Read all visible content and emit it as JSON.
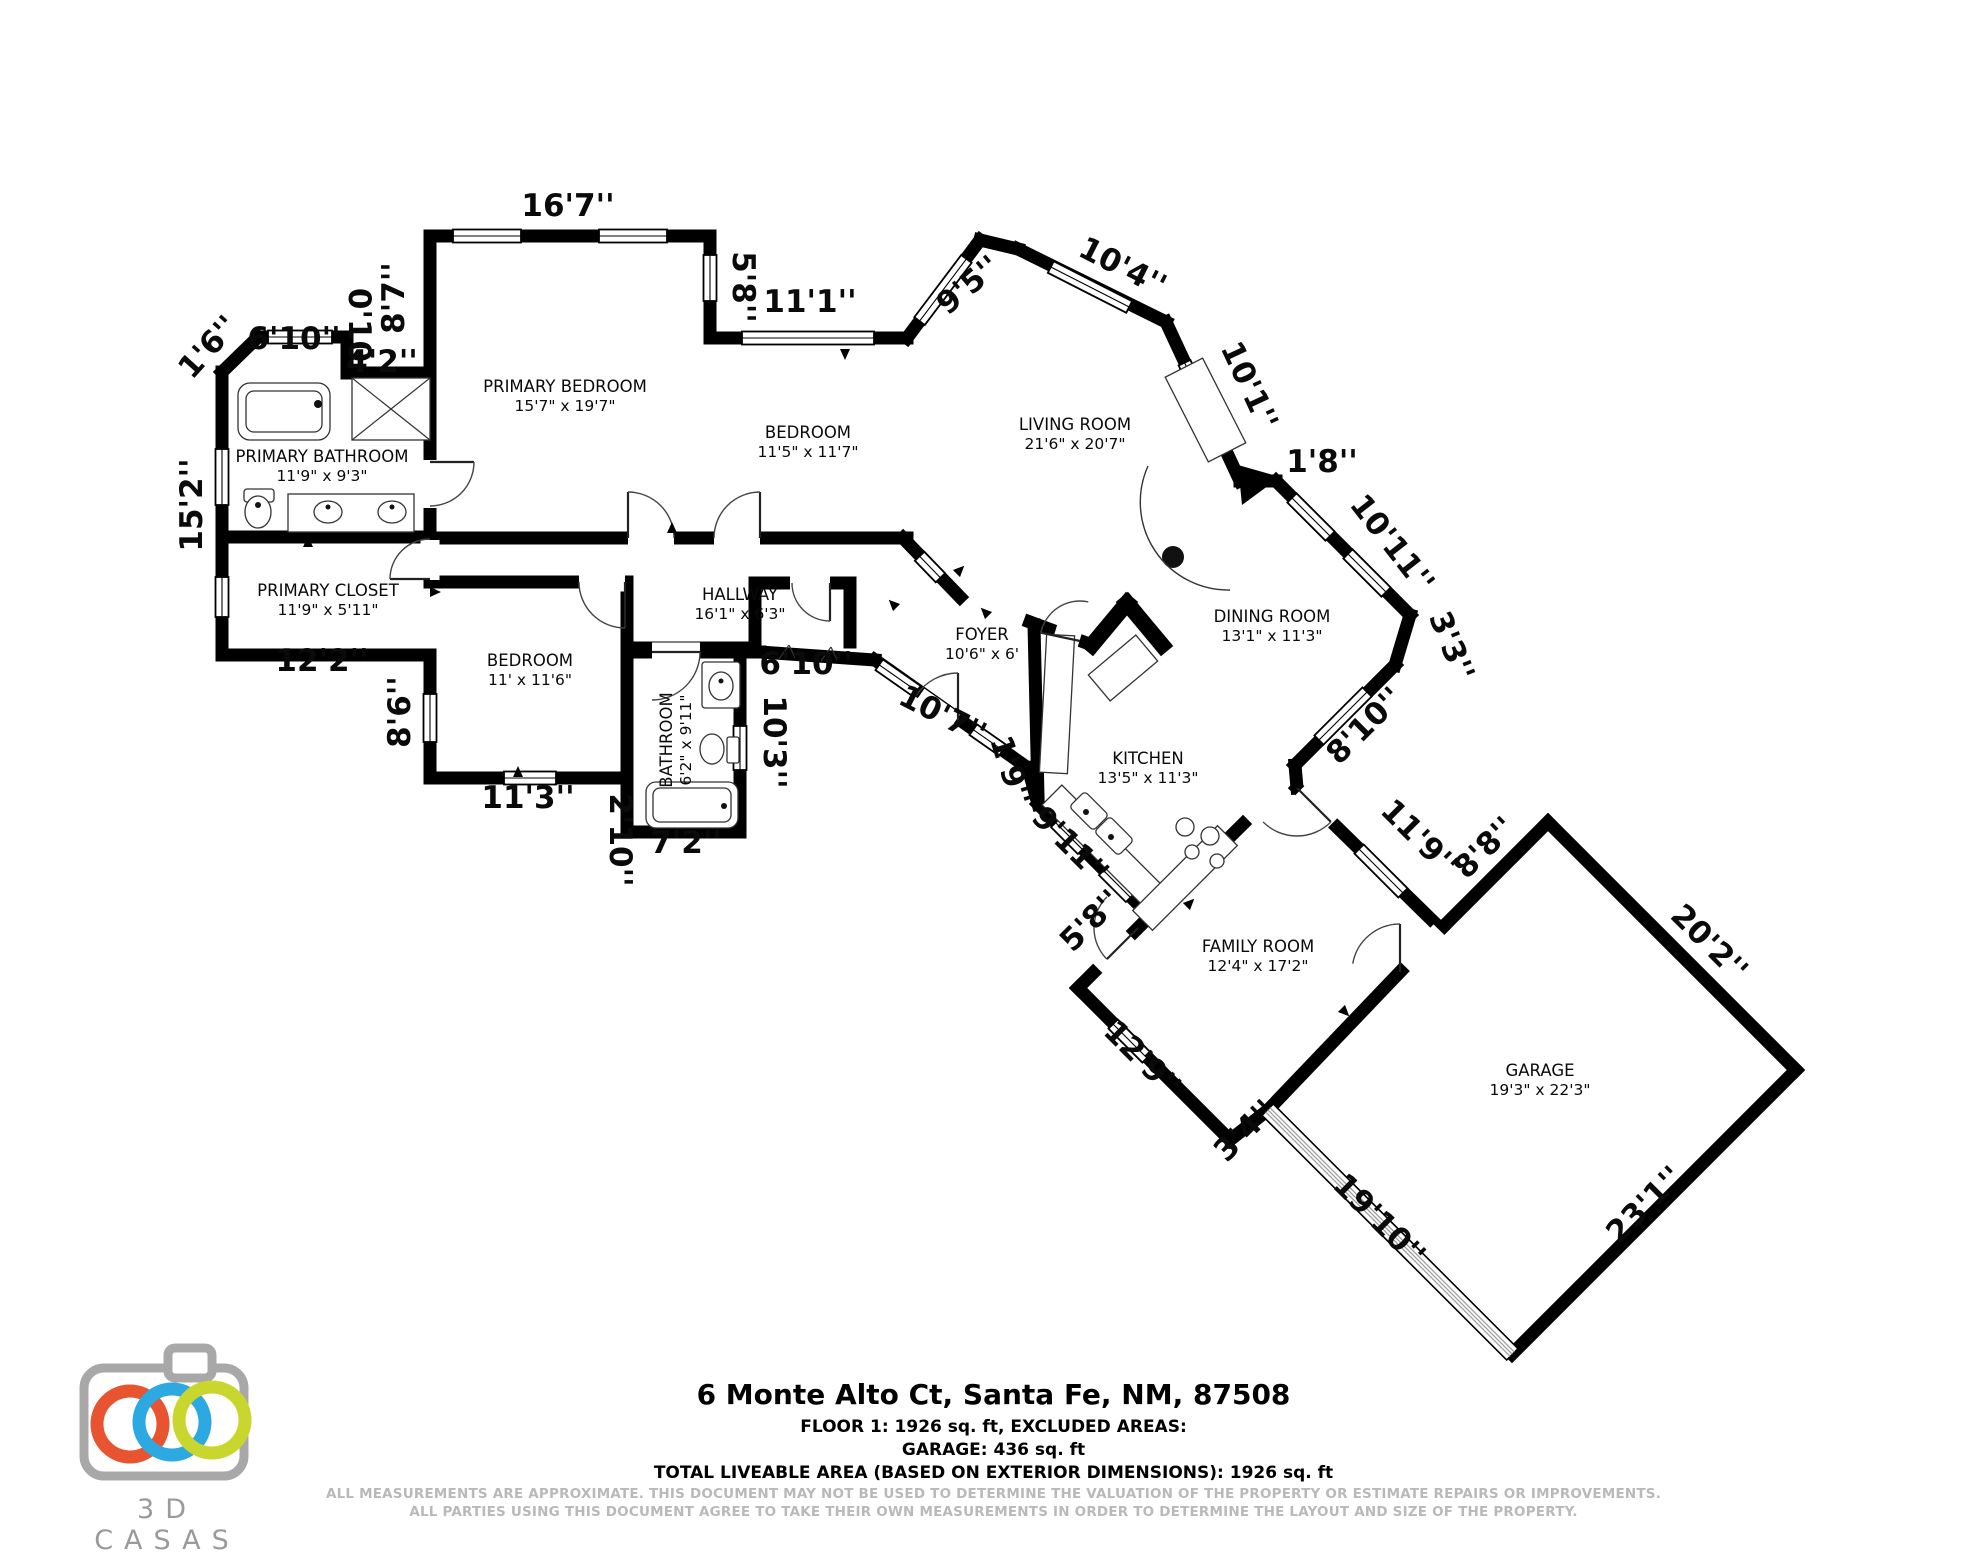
{
  "footer": {
    "title": "6 Monte Alto Ct, Santa Fe, NM, 87508",
    "line1": "FLOOR 1: 1926 sq. ft, EXCLUDED AREAS:",
    "line2": "GARAGE: 436 sq. ft",
    "line3": "TOTAL LIVEABLE AREA (BASED ON EXTERIOR DIMENSIONS): 1926 sq. ft",
    "disclaimer1": "ALL MEASUREMENTS ARE APPROXIMATE. THIS DOCUMENT MAY NOT BE USED TO DETERMINE THE VALUATION OF THE PROPERTY OR ESTIMATE REPAIRS OR IMPROVEMENTS.",
    "disclaimer2": "ALL PARTIES USING THIS DOCUMENT AGREE TO TAKE THEIR OWN MEASUREMENTS IN ORDER TO DETERMINE THE LAYOUT AND SIZE OF THE PROPERTY."
  },
  "logo": {
    "text": "3D CASAS",
    "colors": {
      "body": "#a8a8a8",
      "ring1": "#e8542f",
      "ring2": "#2ba9e0",
      "ring3": "#c9d62e"
    }
  },
  "floorplan": {
    "wall_color": "#000000",
    "rooms": [
      {
        "name": "PRIMARY BEDROOM",
        "dims": "15'7\" x 19'7\"",
        "x": 565,
        "y": 392,
        "rot": 0
      },
      {
        "name": "BEDROOM",
        "dims": "11'5\" x 11'7\"",
        "x": 808,
        "y": 438,
        "rot": 0
      },
      {
        "name": "LIVING ROOM",
        "dims": "21'6\" x 20'7\"",
        "x": 1075,
        "y": 430,
        "rot": 0
      },
      {
        "name": "PRIMARY BATHROOM",
        "dims": "11'9\" x 9'3\"",
        "x": 322,
        "y": 462,
        "rot": 0
      },
      {
        "name": "PRIMARY CLOSET",
        "dims": "11'9\" x 5'11\"",
        "x": 328,
        "y": 596,
        "rot": 0
      },
      {
        "name": "HALLWAY",
        "dims": "16'1\" x 6'3\"",
        "x": 740,
        "y": 600,
        "rot": 0
      },
      {
        "name": "BEDROOM",
        "dims": "11' x 11'6\"",
        "x": 530,
        "y": 666,
        "rot": 0
      },
      {
        "name": "BATHROOM",
        "dims": "6'2\" x 9'11\"",
        "x": 672,
        "y": 740,
        "rot": -90
      },
      {
        "name": "FOYER",
        "dims": "10'6\" x 6'",
        "x": 982,
        "y": 640,
        "rot": 0
      },
      {
        "name": "DINING ROOM",
        "dims": "13'1\" x 11'3\"",
        "x": 1272,
        "y": 622,
        "rot": 0
      },
      {
        "name": "KITCHEN",
        "dims": "13'5\" x 11'3\"",
        "x": 1148,
        "y": 764,
        "rot": 0
      },
      {
        "name": "FAMILY ROOM",
        "dims": "12'4\" x 17'2\"",
        "x": 1258,
        "y": 952,
        "rot": 0
      },
      {
        "name": "GARAGE",
        "dims": "19'3\" x 22'3\"",
        "x": 1540,
        "y": 1076,
        "rot": 0
      }
    ],
    "dim_labels": [
      {
        "t": "16'7''",
        "x": 568,
        "y": 216,
        "rot": 0
      },
      {
        "t": "8'7''",
        "x": 404,
        "y": 298,
        "rot": -90
      },
      {
        "t": "5'8''",
        "x": 733,
        "y": 287,
        "rot": 90
      },
      {
        "t": "11'1''",
        "x": 810,
        "y": 312,
        "rot": 0
      },
      {
        "t": "9'5''",
        "x": 975,
        "y": 293,
        "rot": -40
      },
      {
        "t": "10'4''",
        "x": 1118,
        "y": 276,
        "rot": 27
      },
      {
        "t": "10'1''",
        "x": 1240,
        "y": 390,
        "rot": 65
      },
      {
        "t": "1'8''",
        "x": 1322,
        "y": 472,
        "rot": 0
      },
      {
        "t": "10'11''",
        "x": 1384,
        "y": 550,
        "rot": 52
      },
      {
        "t": "3'3''",
        "x": 1442,
        "y": 650,
        "rot": 68
      },
      {
        "t": "8'10''",
        "x": 1372,
        "y": 733,
        "rot": -45
      },
      {
        "t": "11'9''",
        "x": 1412,
        "y": 845,
        "rot": 45
      },
      {
        "t": "8'8''",
        "x": 1492,
        "y": 855,
        "rot": -45
      },
      {
        "t": "20'2''",
        "x": 1702,
        "y": 950,
        "rot": 45
      },
      {
        "t": "23'1''",
        "x": 1652,
        "y": 1212,
        "rot": -45
      },
      {
        "t": "19'10''",
        "x": 1372,
        "y": 1227,
        "rot": 45
      },
      {
        "t": "3'4''",
        "x": 1252,
        "y": 1138,
        "rot": -45
      },
      {
        "t": "12'9''",
        "x": 1135,
        "y": 1066,
        "rot": 45
      },
      {
        "t": "5'8''",
        "x": 1098,
        "y": 928,
        "rot": -45
      },
      {
        "t": "9'11''",
        "x": 1063,
        "y": 852,
        "rot": 45
      },
      {
        "t": "1'9''",
        "x": 1001,
        "y": 774,
        "rot": 72
      },
      {
        "t": "10'7''",
        "x": 938,
        "y": 724,
        "rot": 27
      },
      {
        "t": "6'10''",
        "x": 806,
        "y": 674,
        "rot": 0
      },
      {
        "t": "10'3''",
        "x": 764,
        "y": 742,
        "rot": 90
      },
      {
        "t": "7'2''",
        "x": 686,
        "y": 853,
        "rot": 0
      },
      {
        "t": "2'10''",
        "x": 610,
        "y": 840,
        "rot": 90
      },
      {
        "t": "11'3''",
        "x": 528,
        "y": 808,
        "rot": 0
      },
      {
        "t": "8'6''",
        "x": 410,
        "y": 712,
        "rot": -90
      },
      {
        "t": "12'2''",
        "x": 322,
        "y": 671,
        "rot": 0
      },
      {
        "t": "15'2''",
        "x": 202,
        "y": 505,
        "rot": -90
      },
      {
        "t": "1'6''",
        "x": 216,
        "y": 354,
        "rot": -48
      },
      {
        "t": "6'10''",
        "x": 294,
        "y": 349,
        "rot": 0
      },
      {
        "t": "0'10",
        "x": 349,
        "y": 325,
        "rot": 90
      },
      {
        "t": "4'2''",
        "x": 382,
        "y": 372,
        "rot": 0
      }
    ],
    "walls": [
      [
        222,
        372,
        258,
        337
      ],
      [
        258,
        337,
        347,
        337
      ],
      [
        347,
        337,
        347,
        373
      ],
      [
        347,
        373,
        430,
        373
      ],
      [
        430,
        373,
        430,
        236
      ],
      [
        430,
        236,
        710,
        236
      ],
      [
        710,
        236,
        710,
        338
      ],
      [
        710,
        338,
        907,
        338
      ],
      [
        907,
        338,
        980,
        240
      ],
      [
        980,
        240,
        1018,
        249
      ],
      [
        1018,
        249,
        1166,
        322
      ],
      [
        1166,
        322,
        1240,
        481
      ],
      [
        1240,
        481,
        1276,
        481
      ],
      [
        1276,
        481,
        1410,
        615
      ],
      [
        1410,
        615,
        1395,
        665
      ],
      [
        1395,
        665,
        1295,
        765
      ],
      [
        1295,
        765,
        1297,
        788
      ],
      [
        1297,
        788,
        1441,
        929
      ],
      [
        1441,
        929,
        1548,
        822
      ],
      [
        1548,
        822,
        1796,
        1070
      ],
      [
        1796,
        1070,
        1512,
        1354
      ],
      [
        1268,
        1110,
        1230,
        1140
      ],
      [
        1230,
        1140,
        1078,
        988
      ],
      [
        1078,
        988,
        1150,
        916
      ],
      [
        1150,
        916,
        1038,
        804
      ],
      [
        1038,
        804,
        1028,
        768
      ],
      [
        1028,
        768,
        875,
        660
      ],
      [
        875,
        660,
        760,
        652
      ],
      [
        760,
        652,
        633,
        652
      ],
      [
        740,
        652,
        740,
        832
      ],
      [
        740,
        832,
        627,
        832
      ],
      [
        627,
        832,
        627,
        778
      ],
      [
        627,
        778,
        430,
        778
      ],
      [
        430,
        778,
        430,
        655
      ],
      [
        430,
        655,
        222,
        655
      ],
      [
        222,
        655,
        222,
        372
      ],
      [
        1441,
        929,
        1268,
        1110
      ],
      [
        222,
        537,
        430,
        537
      ],
      [
        430,
        373,
        430,
        582
      ],
      [
        430,
        538,
        907,
        538
      ],
      [
        430,
        582,
        627,
        582
      ],
      [
        627,
        582,
        627,
        778
      ],
      [
        633,
        648,
        755,
        648
      ],
      [
        755,
        648,
        755,
        583
      ],
      [
        755,
        583,
        850,
        583
      ],
      [
        850,
        583,
        850,
        642
      ],
      [
        903,
        538,
        960,
        597
      ],
      [
        1030,
        622,
        1092,
        645
      ],
      [
        1092,
        645,
        1127,
        603,
        16
      ],
      [
        1127,
        603,
        1162,
        645,
        16
      ],
      [
        1034,
        625,
        1038,
        796
      ],
      [
        1150,
        916,
        1243,
        824
      ]
    ],
    "gaps": [
      [
        430,
        484,
        48,
        90
      ],
      [
        430,
        560,
        40,
        90
      ],
      [
        651,
        538,
        46,
        0
      ],
      [
        737,
        538,
        46,
        0
      ],
      [
        602,
        582,
        46,
        0
      ],
      [
        676,
        652,
        48,
        0
      ],
      [
        937,
        709,
        44,
        35
      ],
      [
        1068,
        634,
        26,
        17
      ],
      [
        1114,
        952,
        46,
        -45
      ],
      [
        1316,
        807,
        46,
        45
      ],
      [
        1423,
        949,
        50,
        -46
      ],
      [
        810,
        583,
        40,
        0
      ]
    ],
    "windows": [
      [
        300,
        337,
        64,
        0
      ],
      [
        222,
        477,
        56,
        90
      ],
      [
        222,
        597,
        40,
        90
      ],
      [
        487,
        236,
        68,
        0
      ],
      [
        633,
        236,
        68,
        0
      ],
      [
        710,
        278,
        46,
        90
      ],
      [
        808,
        338,
        132,
        0
      ],
      [
        943,
        290,
        78,
        -53
      ],
      [
        1090,
        287,
        88,
        27
      ],
      [
        1201,
        398,
        78,
        65
      ],
      [
        1311,
        517,
        54,
        45
      ],
      [
        1367,
        573,
        54,
        45
      ],
      [
        1343,
        716,
        68,
        -45
      ],
      [
        1381,
        871,
        62,
        45
      ],
      [
        930,
        567,
        30,
        46
      ],
      [
        898,
        678,
        46,
        35
      ],
      [
        988,
        740,
        36,
        35
      ],
      [
        740,
        748,
        44,
        90
      ],
      [
        530,
        778,
        52,
        0
      ],
      [
        430,
        718,
        48,
        90
      ],
      [
        1130,
        1041,
        48,
        45
      ],
      [
        1069,
        836,
        38,
        45
      ],
      [
        1117,
        884,
        38,
        45
      ]
    ],
    "garage_door": {
      "cx": 1390,
      "cy": 1232,
      "len": 346,
      "rot": 45
    },
    "doors": [
      [
        430,
        462,
        44,
        0,
        90
      ],
      [
        430,
        579,
        40,
        180,
        270
      ],
      [
        628,
        538,
        46,
        270,
        360
      ],
      [
        760,
        538,
        46,
        270,
        180
      ],
      [
        625,
        582,
        46,
        90,
        180
      ],
      [
        652,
        652,
        48,
        0,
        90
      ],
      [
        958,
        723,
        50,
        270,
        213
      ],
      [
        1080,
        641,
        40,
        192,
        282
      ],
      [
        1138,
        928,
        44,
        135,
        225
      ],
      [
        1297,
        788,
        48,
        45,
        135
      ],
      [
        1400,
        972,
        48,
        270,
        190
      ],
      [
        830,
        583,
        38,
        90,
        180
      ]
    ],
    "fixtures": {
      "rects": [
        [
          238,
          383,
          92,
          57,
          12,
          0
        ],
        [
          246,
          391,
          76,
          41,
          8,
          0
        ],
        [
          352,
          378,
          78,
          62,
          0,
          0
        ],
        [
          288,
          494,
          126,
          38,
          0,
          0
        ],
        [
          244,
          489,
          30,
          13,
          3,
          0
        ],
        [
          702,
          662,
          38,
          46,
          3,
          0
        ],
        [
          727,
          737,
          12,
          26,
          2,
          0
        ],
        [
          646,
          782,
          92,
          46,
          10,
          0
        ],
        [
          653,
          788,
          78,
          34,
          7,
          0
        ],
        [
          1043,
          635,
          28,
          138,
          0,
          3
        ],
        [
          1030,
          834,
          150,
          28,
          0,
          45
        ],
        [
          1125,
          864,
          120,
          28,
          0,
          -45
        ],
        [
          1092,
          651,
          62,
          34,
          0,
          -40
        ],
        [
          1072,
          800,
          34,
          22,
          4,
          45
        ],
        [
          1097,
          825,
          34,
          22,
          4,
          45
        ],
        [
          1158,
          389,
          95,
          42,
          0,
          63
        ]
      ],
      "circles": [
        [
          1185,
          827,
          9
        ],
        [
          1210,
          836,
          9
        ],
        [
          1192,
          852,
          7
        ],
        [
          1217,
          861,
          7
        ]
      ],
      "dots": [
        [
          1173,
          557,
          11
        ],
        [
          1086,
          812,
          3
        ],
        [
          1111,
          837,
          3
        ],
        [
          318,
          404,
          4
        ],
        [
          724,
          806,
          3
        ],
        [
          328,
          507,
          2.5
        ],
        [
          392,
          507,
          2.5
        ],
        [
          721,
          681,
          2.5
        ],
        [
          258,
          505,
          3
        ]
      ],
      "ellipses": [
        [
          258,
          512,
          13,
          16
        ],
        [
          328,
          512,
          14,
          11
        ],
        [
          392,
          512,
          14,
          11
        ],
        [
          721,
          686,
          12,
          14
        ],
        [
          712,
          749,
          12,
          15
        ]
      ],
      "lines": [
        [
          352,
          378,
          430,
          440
        ],
        [
          430,
          378,
          352,
          440
        ],
        [
          779,
          659,
          789,
          645
        ],
        [
          789,
          645,
          795,
          658
        ],
        [
          821,
          661,
          831,
          647
        ],
        [
          831,
          647,
          837,
          660
        ]
      ],
      "paths": [
        "M 1148,466 A 88 88 0 0 0 1230,590"
      ],
      "polygons": [
        [
          1238,
          465,
          1280,
          477,
          1242,
          505
        ]
      ]
    },
    "arrows": [
      [
        845,
        354,
        180
      ],
      [
        518,
        772,
        0
      ],
      [
        672,
        528,
        0
      ],
      [
        308,
        542,
        0
      ],
      [
        893,
        604,
        315
      ],
      [
        985,
        612,
        315
      ],
      [
        1190,
        903,
        45
      ],
      [
        960,
        570,
        45
      ],
      [
        1345,
        1012,
        135
      ],
      [
        435,
        592,
        90
      ]
    ]
  }
}
